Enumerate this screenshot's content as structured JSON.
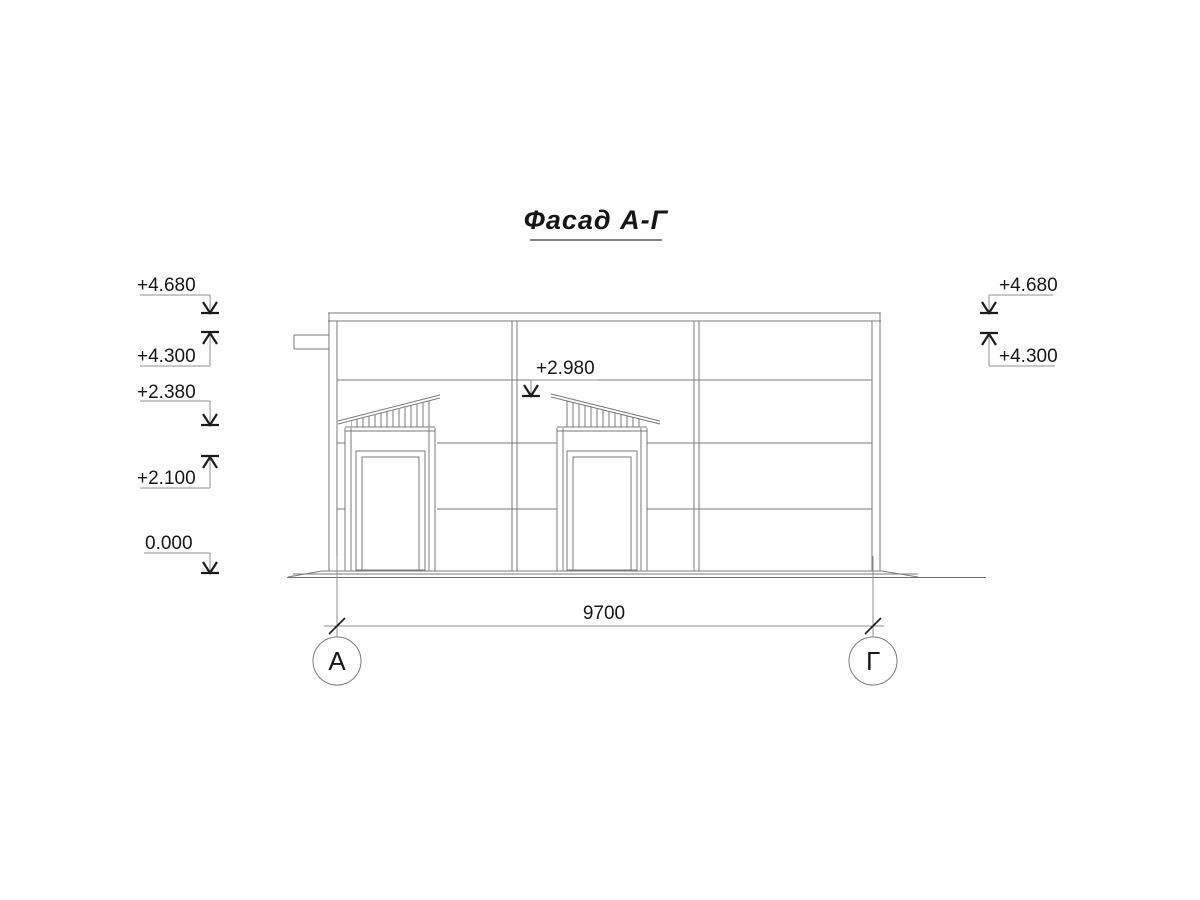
{
  "title": {
    "text": "Фасад А-Г"
  },
  "elevation_marks": {
    "left": [
      {
        "label": "+4.680",
        "direction": "down"
      },
      {
        "label": "+4.300",
        "direction": "up"
      },
      {
        "label": "+2.380",
        "direction": "down"
      },
      {
        "label": "+2.100",
        "direction": "up"
      },
      {
        "label": "0.000",
        "direction": "down"
      }
    ],
    "right": [
      {
        "label": "+4.680",
        "direction": "down"
      },
      {
        "label": "+4.300",
        "direction": "up"
      }
    ],
    "center": [
      {
        "label": "+2.980",
        "direction": "down"
      }
    ]
  },
  "dimensions": {
    "overall_width": "9700"
  },
  "axes": {
    "left": "А",
    "right": "Г"
  },
  "colors": {
    "background": "#ffffff",
    "thin_line": "#7a7a7a",
    "leader_line": "#8f8f8f",
    "dark_line": "#1c1c1c",
    "text": "#161616"
  }
}
